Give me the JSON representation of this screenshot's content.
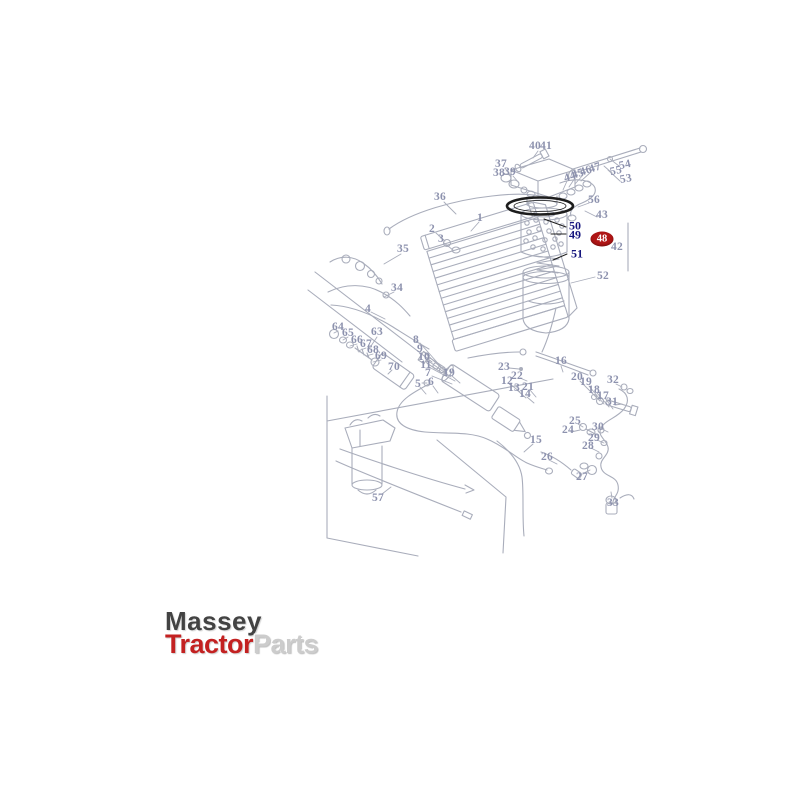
{
  "page": {
    "background": "#ffffff"
  },
  "logo": {
    "line1": "Massey",
    "line2_red": "Tractor",
    "line2_gray": "Parts",
    "color_red": "#c32121",
    "color_dark": "#434343",
    "color_gray": "#cccccc"
  },
  "diagram": {
    "stroke_color": "#a9adbb",
    "label_color": "#8d92ae",
    "emphasis_color": "#15157d",
    "ink_color": "#1d1d1d",
    "badge": {
      "t": "48",
      "x": 602,
      "y": 239,
      "bg": "#b01515",
      "fg": "#ffffff"
    },
    "emphasis_labels": [
      {
        "t": "50",
        "x": 575,
        "y": 226
      },
      {
        "t": "49",
        "x": 575,
        "y": 235
      },
      {
        "t": "51",
        "x": 577,
        "y": 254
      }
    ],
    "labels": [
      {
        "t": "1",
        "x": 480,
        "y": 218
      },
      {
        "t": "2",
        "x": 432,
        "y": 229
      },
      {
        "t": "3",
        "x": 441,
        "y": 239
      },
      {
        "t": "4",
        "x": 368,
        "y": 309
      },
      {
        "t": "5",
        "x": 418,
        "y": 384
      },
      {
        "t": "6",
        "x": 431,
        "y": 382
      },
      {
        "t": "7",
        "x": 428,
        "y": 373
      },
      {
        "t": "8",
        "x": 416,
        "y": 340
      },
      {
        "t": "9",
        "x": 420,
        "y": 349
      },
      {
        "t": "10",
        "x": 424,
        "y": 357
      },
      {
        "t": "11",
        "x": 426,
        "y": 365
      },
      {
        "t": "12",
        "x": 507,
        "y": 381
      },
      {
        "t": "13",
        "x": 514,
        "y": 388
      },
      {
        "t": "14",
        "x": 525,
        "y": 394
      },
      {
        "t": "15",
        "x": 536,
        "y": 440
      },
      {
        "t": "16",
        "x": 561,
        "y": 361
      },
      {
        "t": "17",
        "x": 603,
        "y": 396
      },
      {
        "t": "18",
        "x": 594,
        "y": 390
      },
      {
        "t": "19",
        "x": 449,
        "y": 373
      },
      {
        "t": "19",
        "x": 586,
        "y": 382
      },
      {
        "t": "20",
        "x": 577,
        "y": 377
      },
      {
        "t": "21",
        "x": 528,
        "y": 387
      },
      {
        "t": "22",
        "x": 517,
        "y": 376
      },
      {
        "t": "23",
        "x": 504,
        "y": 367
      },
      {
        "t": "24",
        "x": 568,
        "y": 430
      },
      {
        "t": "25",
        "x": 575,
        "y": 421
      },
      {
        "t": "26",
        "x": 547,
        "y": 457
      },
      {
        "t": "27",
        "x": 582,
        "y": 477
      },
      {
        "t": "28",
        "x": 588,
        "y": 446
      },
      {
        "t": "29",
        "x": 594,
        "y": 438
      },
      {
        "t": "30",
        "x": 598,
        "y": 427
      },
      {
        "t": "31",
        "x": 612,
        "y": 402
      },
      {
        "t": "32",
        "x": 613,
        "y": 380
      },
      {
        "t": "33",
        "x": 613,
        "y": 503
      },
      {
        "t": "34",
        "x": 397,
        "y": 288
      },
      {
        "t": "35",
        "x": 403,
        "y": 249
      },
      {
        "t": "36",
        "x": 440,
        "y": 197
      },
      {
        "t": "37",
        "x": 501,
        "y": 164
      },
      {
        "t": "38",
        "x": 499,
        "y": 173
      },
      {
        "t": "39",
        "x": 510,
        "y": 172
      },
      {
        "t": "40",
        "x": 535,
        "y": 146
      },
      {
        "t": "41",
        "x": 546,
        "y": 146
      },
      {
        "t": "42",
        "x": 617,
        "y": 247
      },
      {
        "t": "43",
        "x": 602,
        "y": 215
      },
      {
        "t": "44",
        "x": 570,
        "y": 177,
        "r": -18
      },
      {
        "t": "45",
        "x": 578,
        "y": 174,
        "r": -18
      },
      {
        "t": "46",
        "x": 586,
        "y": 171,
        "r": -18
      },
      {
        "t": "47",
        "x": 595,
        "y": 168,
        "r": -18
      },
      {
        "t": "52",
        "x": 603,
        "y": 276
      },
      {
        "t": "53",
        "x": 626,
        "y": 179,
        "r": -10
      },
      {
        "t": "54",
        "x": 625,
        "y": 165,
        "r": -12
      },
      {
        "t": "55",
        "x": 616,
        "y": 171,
        "r": -12
      },
      {
        "t": "56",
        "x": 594,
        "y": 200
      },
      {
        "t": "57",
        "x": 378,
        "y": 498
      },
      {
        "t": "63",
        "x": 377,
        "y": 332
      },
      {
        "t": "64",
        "x": 338,
        "y": 327
      },
      {
        "t": "65",
        "x": 348,
        "y": 333
      },
      {
        "t": "66",
        "x": 357,
        "y": 340
      },
      {
        "t": "67",
        "x": 366,
        "y": 344
      },
      {
        "t": "68",
        "x": 373,
        "y": 350
      },
      {
        "t": "69",
        "x": 381,
        "y": 356
      },
      {
        "t": "70",
        "x": 394,
        "y": 367
      }
    ]
  }
}
